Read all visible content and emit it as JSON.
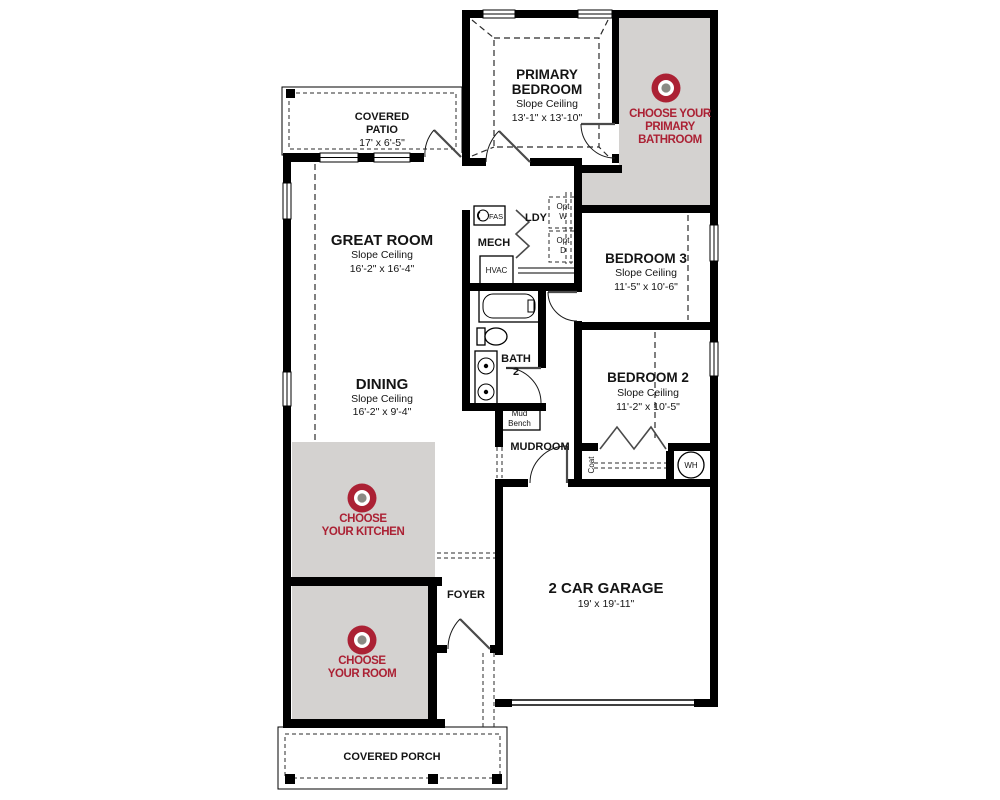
{
  "plan_title": "Single story floor plan",
  "colors": {
    "wall": "#000000",
    "option_zone_bg": "#d4d2d0",
    "accent_red": "#ab2134",
    "target_center_gray": "#8a8a84"
  },
  "rooms": {
    "covered_patio": {
      "name1": "COVERED",
      "name2": "PATIO",
      "dims": "17' x 6'-5\""
    },
    "primary_bedroom": {
      "name1": "PRIMARY",
      "name2": "BEDROOM",
      "ceiling": "Slope Ceiling",
      "dims": "13'-1\" x 13'-10\""
    },
    "great_room": {
      "name": "GREAT ROOM",
      "ceiling": "Slope Ceiling",
      "dims": "16'-2\" x 16'-4\""
    },
    "dining": {
      "name": "DINING",
      "ceiling": "Slope Ceiling",
      "dims": "16'-2\" x 9'-4\""
    },
    "bedroom3": {
      "name": "BEDROOM 3",
      "ceiling": "Slope Ceiling",
      "dims": "11'-5\" x 10'-6\""
    },
    "bedroom2": {
      "name": "BEDROOM 2",
      "ceiling": "Slope Ceiling",
      "dims": "11'-2\" x 10'-5\""
    },
    "bath2": {
      "name1": "BATH",
      "name2": "2"
    },
    "ldy": {
      "name": "LDY"
    },
    "mech": {
      "name": "MECH"
    },
    "mudroom": {
      "name": "MUDROOM"
    },
    "foyer": {
      "name": "FOYER"
    },
    "garage": {
      "name": "2 CAR GARAGE",
      "dims": "19' x 19'-11\""
    },
    "covered_porch": {
      "name": "COVERED PORCH"
    }
  },
  "fixtures": {
    "fas": "FAS",
    "hvac": "HVAC",
    "opt_w1": "Opt",
    "opt_w2": "W",
    "opt_d1": "Opt",
    "opt_d2": "D",
    "mud_bench1": "Mud",
    "mud_bench2": "Bench",
    "coat": "Coat",
    "water_heater": "WH"
  },
  "options": [
    {
      "id": "primary-bathroom",
      "line1": "CHOOSE YOUR",
      "line2": "PRIMARY",
      "line3": "BATHROOM"
    },
    {
      "id": "kitchen",
      "line1": "CHOOSE",
      "line2": "YOUR KITCHEN"
    },
    {
      "id": "room",
      "line1": "CHOOSE",
      "line2": "YOUR ROOM"
    }
  ]
}
